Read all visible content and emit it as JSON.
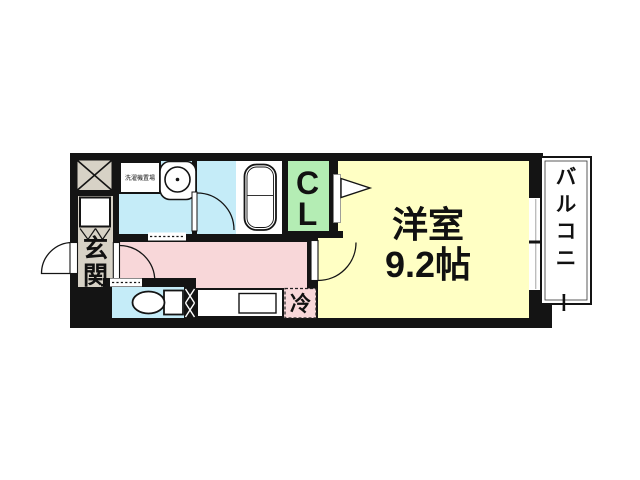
{
  "floor_plan": {
    "rooms": {
      "main_room": {
        "name": "洋室",
        "size": "9.2帖"
      },
      "closet": {
        "label": "CL",
        "chars": [
          "C",
          "L"
        ]
      },
      "balcony": {
        "label": "バルコニー"
      },
      "entrance": {
        "label": "玄関"
      },
      "kitchen": {
        "refrigerator_label": "冷"
      },
      "washroom": {
        "laundry_label": "洗濯機置場"
      }
    },
    "colors": {
      "wall": "#141414",
      "main_room": "#ffffc4",
      "kitchen": "#f8d7d9",
      "wet_area": "#c5ecf8",
      "closet": "#b4edb4",
      "entrance": "#d7d2c6",
      "fixture": "#ffffff"
    }
  }
}
